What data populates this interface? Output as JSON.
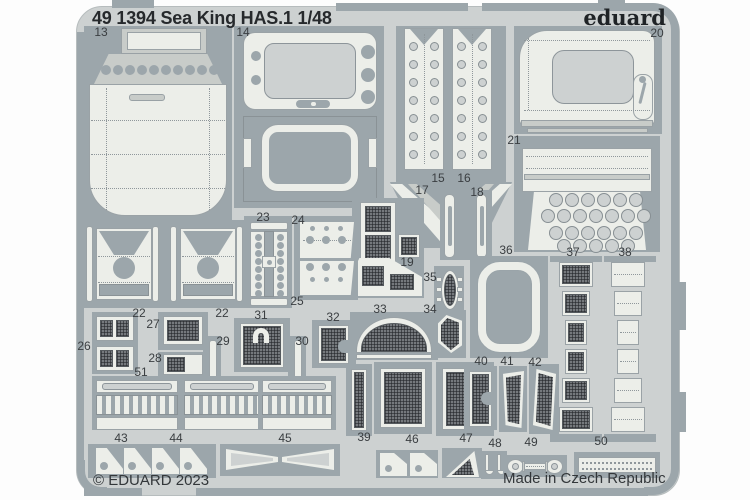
{
  "header": {
    "catalog_title": "49 1394 Sea King HAS.1 1/48",
    "brand": "eduard"
  },
  "footer": {
    "copyright": "© EDUARD 2023",
    "made_in": "Made in Czech Republic"
  },
  "colors": {
    "page_bg": "#fdfdfd",
    "fret": "#cdd1d1",
    "frame": "#9ca6ab",
    "part": "#c8ccc9",
    "face": "#eceee9",
    "label": "#3a3e41"
  },
  "parts": [
    {
      "number": "13"
    },
    {
      "number": "14"
    },
    {
      "number": "15"
    },
    {
      "number": "16"
    },
    {
      "number": "17"
    },
    {
      "number": "18"
    },
    {
      "number": "19"
    },
    {
      "number": "20"
    },
    {
      "number": "21"
    },
    {
      "number": "22"
    },
    {
      "number": "22"
    },
    {
      "number": "23"
    },
    {
      "number": "24"
    },
    {
      "number": "25"
    },
    {
      "number": "26"
    },
    {
      "number": "27"
    },
    {
      "number": "28"
    },
    {
      "number": "29"
    },
    {
      "number": "30"
    },
    {
      "number": "31"
    },
    {
      "number": "32"
    },
    {
      "number": "33"
    },
    {
      "number": "34"
    },
    {
      "number": "35"
    },
    {
      "number": "36"
    },
    {
      "number": "37"
    },
    {
      "number": "38"
    },
    {
      "number": "39"
    },
    {
      "number": "40"
    },
    {
      "number": "41"
    },
    {
      "number": "42"
    },
    {
      "number": "43"
    },
    {
      "number": "44"
    },
    {
      "number": "45"
    },
    {
      "number": "46"
    },
    {
      "number": "47"
    },
    {
      "number": "48"
    },
    {
      "number": "49"
    },
    {
      "number": "50"
    },
    {
      "number": "51"
    }
  ]
}
